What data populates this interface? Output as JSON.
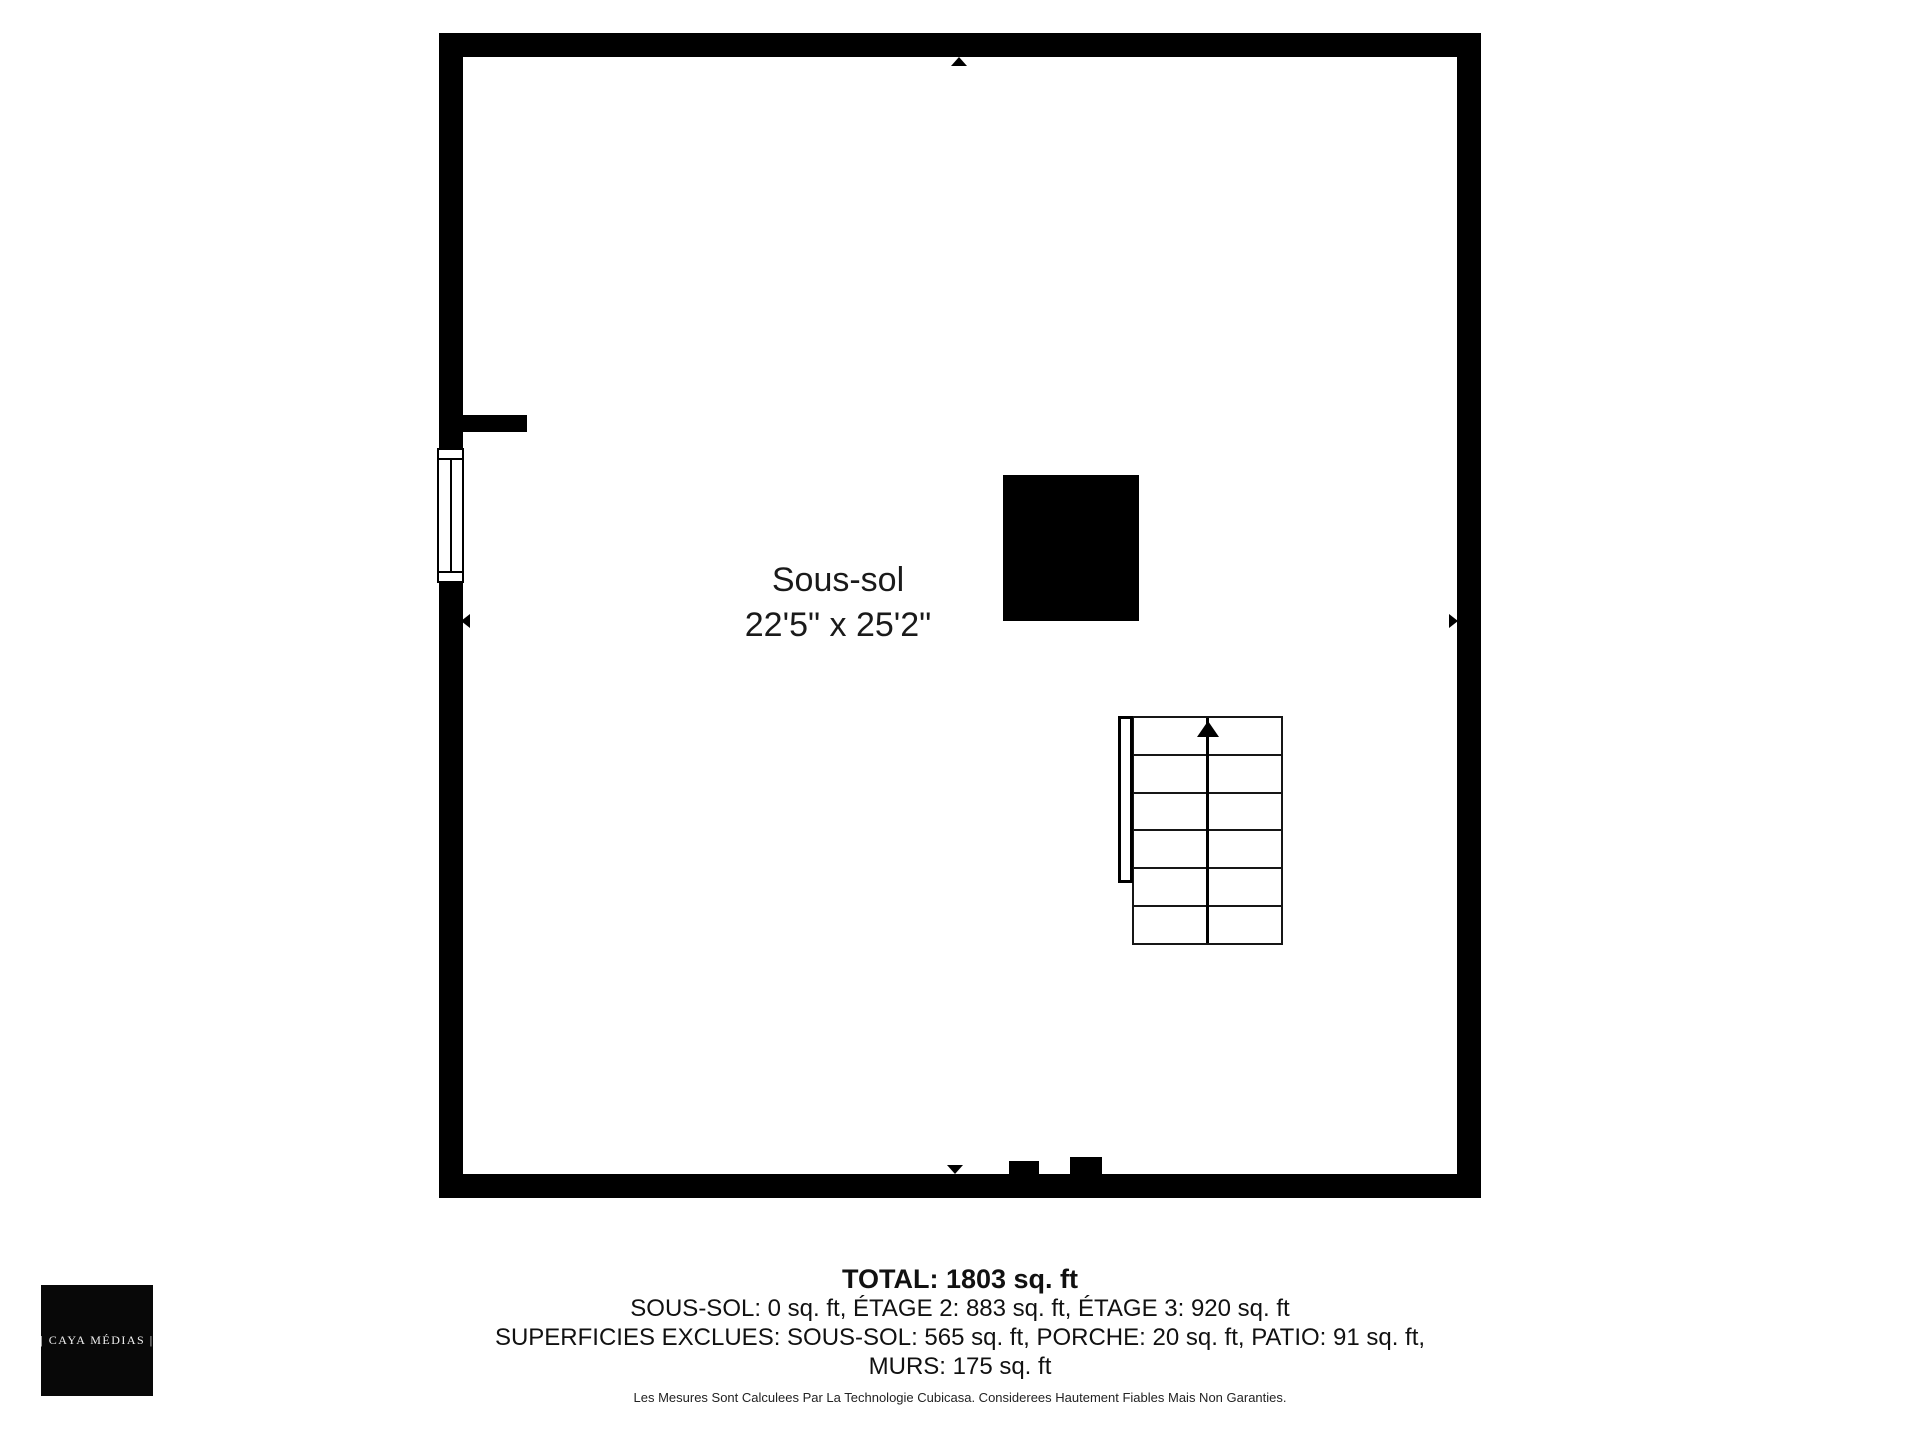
{
  "colors": {
    "wall": "#000000",
    "background": "#ffffff",
    "text": "#1a1a1a"
  },
  "floor_plan": {
    "room": {
      "name": "Sous-sol",
      "dimensions": "22'5\" x 25'2\""
    },
    "stairs": {
      "step_count": 6,
      "direction_icon": "up-arrow"
    }
  },
  "summary": {
    "total_line": "TOTAL: 1803 sq. ft",
    "areas_line": "SOUS-SOL: 0 sq. ft, ÉTAGE 2: 883 sq. ft, ÉTAGE 3: 920 sq. ft",
    "excluded_line_1": "SUPERFICIES EXCLUES: SOUS-SOL: 565 sq. ft, PORCHE: 20 sq. ft, PATIO: 91 sq. ft,",
    "excluded_line_2": "MURS: 175 sq. ft",
    "values": {
      "total_sq_ft": 1803,
      "sous_sol_sq_ft": 0,
      "etage_2_sq_ft": 883,
      "etage_3_sq_ft": 920,
      "exclues_sous_sol_sq_ft": 565,
      "porche_sq_ft": 20,
      "patio_sq_ft": 91,
      "murs_sq_ft": 175
    }
  },
  "disclaimer": "Les Mesures Sont Calculees Par La Technologie Cubicasa. Considerees Hautement Fiables Mais Non Garanties.",
  "logo": {
    "text": "| CAYA MÉDIAS |"
  }
}
